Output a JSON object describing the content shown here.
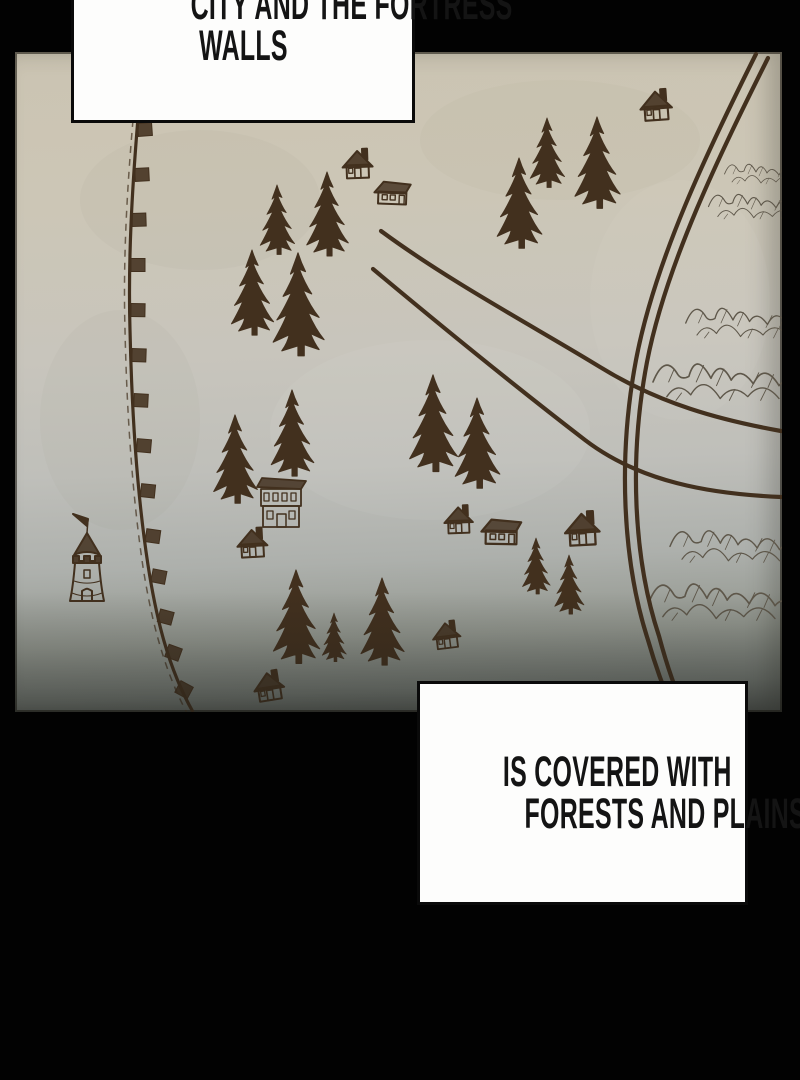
{
  "captions": {
    "top": {
      "line1": "CITY AND THE FORTRESS",
      "line2": "WALLS"
    },
    "bottom": {
      "line1": "IS COVERED WITH",
      "line2": "FORESTS AND PLAINS."
    }
  },
  "map": {
    "colors": {
      "page_bg": "#020202",
      "parchment_light": "#ccc6b6",
      "parchment_dark": "#585c58",
      "ink": "#42301e",
      "mountain_ink": "#5e574a",
      "caption_bg": "#fdfdfc",
      "caption_border": "#0a0a0a"
    },
    "features": {
      "trees": [
        [
          277,
          252,
          67
        ],
        [
          327,
          253,
          81
        ],
        [
          252,
          332,
          82
        ],
        [
          298,
          352,
          99
        ],
        [
          519,
          245,
          87
        ],
        [
          547,
          185,
          67
        ],
        [
          597,
          205,
          88
        ],
        [
          433,
          468,
          93
        ],
        [
          477,
          485,
          87
        ],
        [
          235,
          500,
          85
        ],
        [
          292,
          473,
          83
        ],
        [
          536,
          592,
          54
        ],
        [
          569,
          612,
          57
        ],
        [
          296,
          660,
          90
        ],
        [
          334,
          660,
          47
        ],
        [
          382,
          662,
          84
        ]
      ],
      "houses": [
        {
          "type": "house1",
          "x": 358,
          "y": 178,
          "s": 1.0,
          "r": -2
        },
        {
          "type": "house2",
          "x": 392,
          "y": 204,
          "s": 1.0,
          "r": 2
        },
        {
          "type": "house1",
          "x": 657,
          "y": 120,
          "s": 1.05,
          "r": -4
        },
        {
          "type": "house1",
          "x": 459,
          "y": 533,
          "s": 0.95,
          "r": -2
        },
        {
          "type": "house2",
          "x": 501,
          "y": 544,
          "s": 1.1,
          "r": 1
        },
        {
          "type": "house1",
          "x": 583,
          "y": 545,
          "s": 1.15,
          "r": -3
        },
        {
          "type": "house1",
          "x": 253,
          "y": 557,
          "s": 1.0,
          "r": -3
        },
        {
          "type": "house1",
          "x": 448,
          "y": 648,
          "s": 0.92,
          "r": -7
        },
        {
          "type": "house1",
          "x": 271,
          "y": 700,
          "s": 1.0,
          "r": -9
        }
      ],
      "building": {
        "x": 281,
        "y": 527,
        "s": 1.0
      },
      "tower": {
        "x": 87,
        "y": 601,
        "s": 1.0
      },
      "mountains": [
        {
          "x": 762,
          "y": 180,
          "s": 0.5
        },
        {
          "x": 755,
          "y": 214,
          "s": 0.62
        },
        {
          "x": 742,
          "y": 332,
          "s": 0.75
        },
        {
          "x": 722,
          "y": 393,
          "s": 0.92
        },
        {
          "x": 730,
          "y": 556,
          "s": 0.8
        },
        {
          "x": 718,
          "y": 613,
          "s": 0.92
        }
      ],
      "roads": [
        "M 381,231 C 450,282 540,330 600,367 C 660,404 720,420 781,431",
        "M 373,269 C 440,325 520,390 585,440 C 640,482 710,494 781,497",
        "M 756,54 C 708,150 655,260 636,360 C 618,455 622,560 648,640 C 656,668 665,692 674,713",
        "M 768,58 C 720,154 666,264 647,362 C 629,456 633,558 659,636 C 667,666 676,692 686,713"
      ],
      "wall": {
        "line": "M 138,118 C 132,190 128,260 130,330 C 132,420 138,500 148,565 C 156,617 168,668 193,712",
        "inner": "M 133,120 C 127,190 123,260 125,330 C 127,420 133,500 143,567 C 151,618 163,668 187,713",
        "blocks": [
          [
            137,
            130,
            -4
          ],
          [
            134,
            175,
            -3
          ],
          [
            131,
            220,
            -2
          ],
          [
            130,
            265,
            0
          ],
          [
            130,
            310,
            1
          ],
          [
            131,
            355,
            2
          ],
          [
            133,
            400,
            3
          ],
          [
            136,
            445,
            5
          ],
          [
            140,
            490,
            6
          ],
          [
            145,
            535,
            8
          ],
          [
            151,
            575,
            11
          ],
          [
            158,
            615,
            15
          ],
          [
            166,
            650,
            20
          ],
          [
            177,
            686,
            28
          ]
        ]
      }
    }
  }
}
